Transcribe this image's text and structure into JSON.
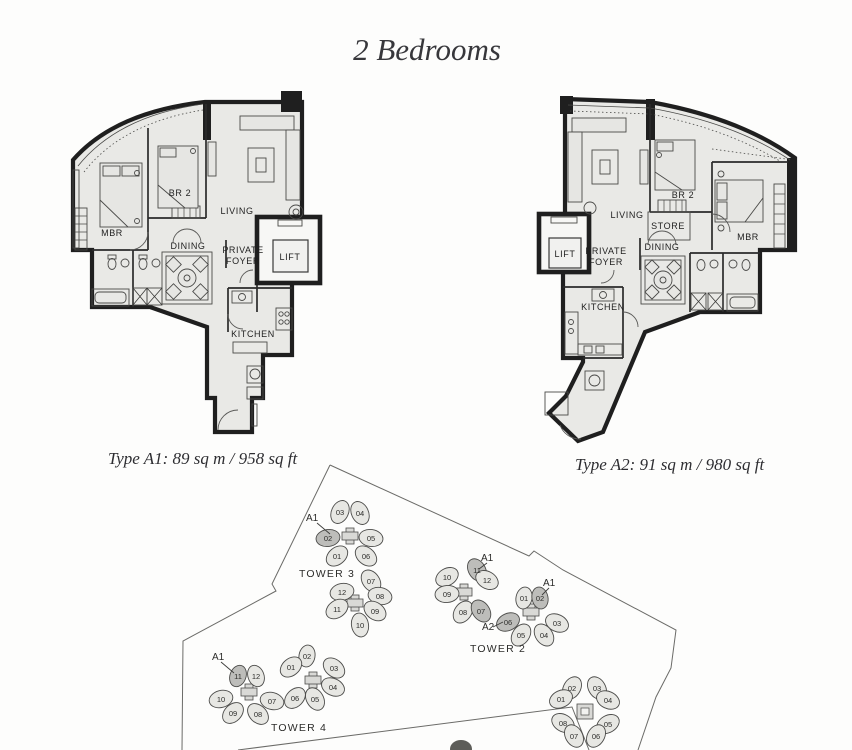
{
  "title": "2 Bedrooms",
  "plans": [
    {
      "type_label": "A1",
      "caption": "Type A1: 89 sq m / 958 sq ft",
      "rooms": {
        "mbr": "MBR",
        "br2": "BR 2",
        "living": "LIVING",
        "dining": "DINING",
        "foyer_line1": "PRIVATE",
        "foyer_line2": "FOYER",
        "lift": "LIFT",
        "kitchen": "KITCHEN"
      }
    },
    {
      "type_label": "A2",
      "caption": "Type A2: 91 sq m / 980 sq ft",
      "rooms": {
        "living": "LIVING",
        "br2": "BR 2",
        "store": "STORE",
        "mbr": "MBR",
        "foyer_line1": "PRIVATE",
        "foyer_line2": "FOYER",
        "lift": "LIFT",
        "dining": "DINING",
        "kitchen": "KITCHEN"
      }
    }
  ],
  "site_map": {
    "towers": [
      {
        "name": "TOWER 3",
        "callouts": [
          "A1"
        ],
        "units": [
          "03",
          "04",
          "02",
          "05",
          "01",
          "06",
          "07",
          "12",
          "08",
          "11",
          "09",
          "10"
        ]
      },
      {
        "name": "TOWER 2",
        "callouts": [
          "A1",
          "A1",
          "A2"
        ],
        "units": [
          "11",
          "12",
          "10",
          "09",
          "08",
          "07",
          "01",
          "02",
          "03",
          "06",
          "05",
          "04"
        ]
      },
      {
        "name": "TOWER 4",
        "callouts": [
          "A1"
        ],
        "units": [
          "11",
          "12",
          "10",
          "09",
          "08",
          "07",
          "02",
          "01",
          "03",
          "04",
          "06",
          "05"
        ]
      },
      {
        "name": "",
        "callouts": [],
        "units": [
          "02",
          "03",
          "01",
          "04",
          "08",
          "05",
          "07",
          "06"
        ]
      }
    ],
    "colors": {
      "highlight_fill": "#bdbdba",
      "unit_fill": "#e7e7e3",
      "floor_fill": "#e9e9e6",
      "wall": "#1f1f1f"
    }
  }
}
